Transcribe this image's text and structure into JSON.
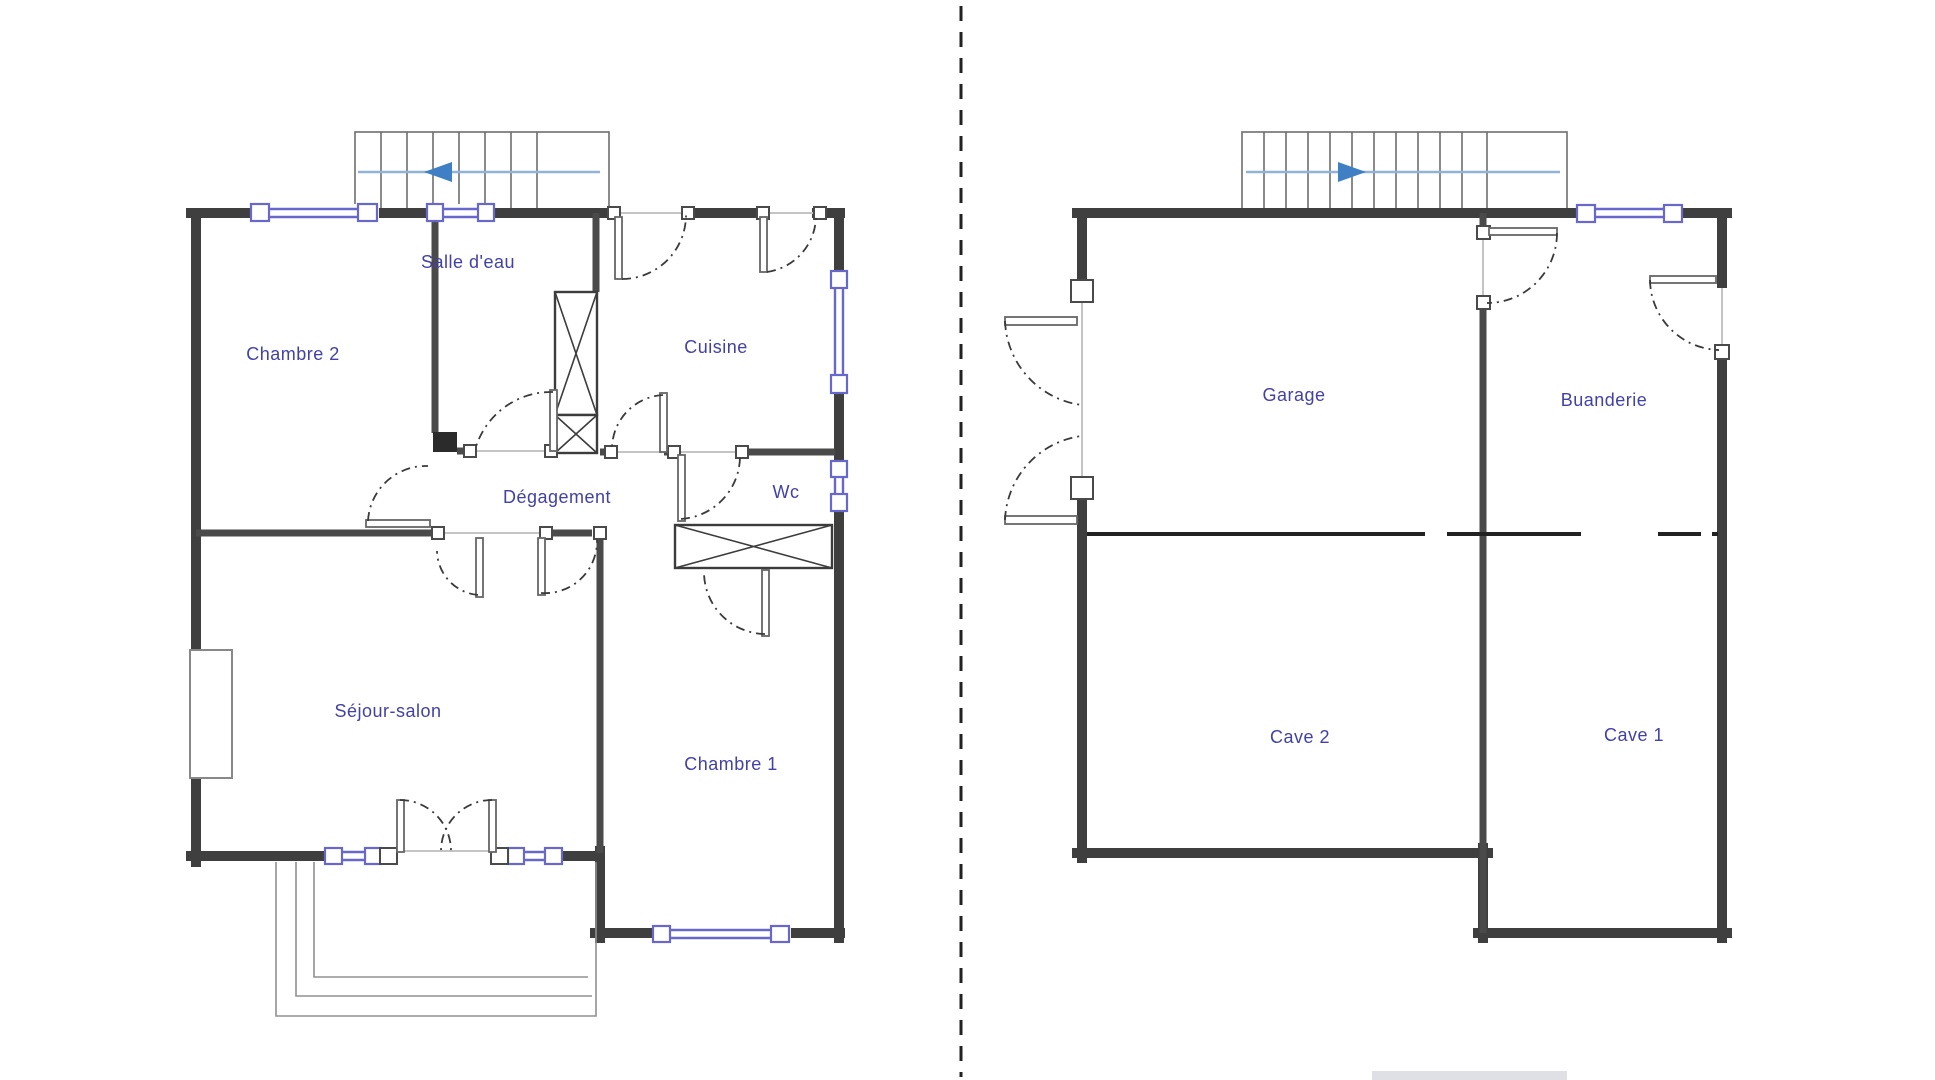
{
  "document": {
    "type": "architectural floor plan drawing",
    "plan_count": 2,
    "background": "#ffffff"
  },
  "plans": {
    "upper_floor": {
      "rooms": [
        {
          "id": "salle-deau",
          "label": "Salle d'eau"
        },
        {
          "id": "chambre-2",
          "label": "Chambre 2"
        },
        {
          "id": "cuisine",
          "label": "Cuisine"
        },
        {
          "id": "degagement",
          "label": "Dégagement"
        },
        {
          "id": "wc",
          "label": "Wc"
        },
        {
          "id": "sejour-salon",
          "label": "Séjour-salon"
        },
        {
          "id": "chambre-1",
          "label": "Chambre 1"
        }
      ],
      "stair_arrow_direction": "left"
    },
    "basement": {
      "rooms": [
        {
          "id": "garage",
          "label": "Garage"
        },
        {
          "id": "buanderie",
          "label": "Buanderie"
        },
        {
          "id": "cave-2",
          "label": "Cave 2"
        },
        {
          "id": "cave-1",
          "label": "Cave 1"
        }
      ],
      "stair_arrow_direction": "right"
    }
  },
  "colors": {
    "wall": "#3f3f3f",
    "iwall": "#4a4a4a",
    "window": "#6868cc",
    "label": "#4141a6",
    "arrow": "#3f7fc4",
    "stairline": "#8fb3d9",
    "arc": "#3a3a3a",
    "threshold": "#c4c4c4",
    "separator": "#222222",
    "patio": "#909090",
    "duct": "#3c3c3c",
    "chimney": "#888888",
    "block": "#2b2b2b",
    "artifact": "#c2c6cf"
  }
}
